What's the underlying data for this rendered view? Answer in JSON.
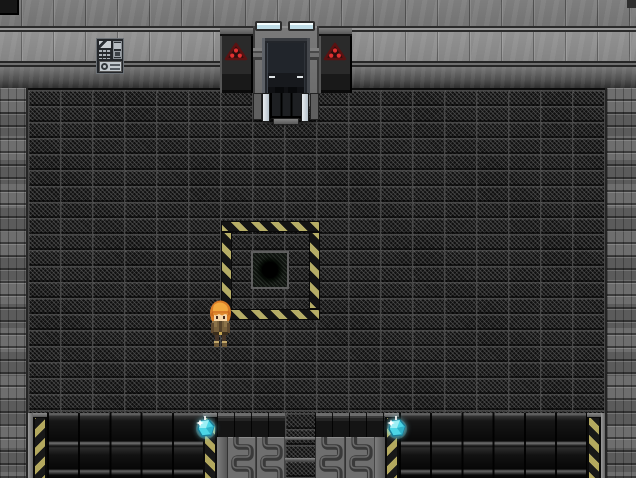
{
  "scene": {
    "type": "top-down sci-fi facility interior (RPG-style game screen)",
    "width": 636,
    "height": 478,
    "visible_text": "none"
  },
  "colors": {
    "hazard_yellow": "#b3a85e",
    "hazard_black": "#181818",
    "warning_red": "#e03030",
    "crystal_cyan": "#4cd6e6",
    "light_cyan_white": "#f5feff",
    "wall_gray": "#7e7e7e",
    "floor_dark": "#101010",
    "stone_gray": "#6e6e6e"
  },
  "entities": {
    "player": {
      "description": "Orange-haired hero character facing down, brown armor",
      "x": 207,
      "y": 299
    },
    "door": {
      "description": "Sealed dark sliding door with gray frame and ramp",
      "x": 253,
      "y": 26
    },
    "warning_panels": {
      "count": 2,
      "description": "Dark wall panels with red triangular three-dot hazard signs flanking the door"
    },
    "ceiling_lights": {
      "count": 2,
      "description": "Cyan-white light bars above the door"
    },
    "wall_poster": {
      "description": "Small info poster/control panel on upper-left wall",
      "x": 96,
      "y": 38
    },
    "hazard_square": {
      "description": "Yellow/black striped square border on floor",
      "x": 221,
      "y": 221,
      "size": 99
    },
    "floor_hole": {
      "description": "Dark circular hole on framed plate inside hazard square",
      "x": 251,
      "y": 251
    },
    "crystals": [
      {
        "description": "Cyan crystal pickup on left pit edge",
        "x": 194,
        "y": 416
      },
      {
        "description": "Cyan crystal pickup on right pit edge",
        "x": 385,
        "y": 416
      }
    ],
    "pits": {
      "count": 2,
      "description": "Dark recessed pits with hazard-striped edge columns at bottom of room"
    },
    "radiator_machine": {
      "description": "Gray radiator coil machine with central walkway between the pits"
    }
  }
}
